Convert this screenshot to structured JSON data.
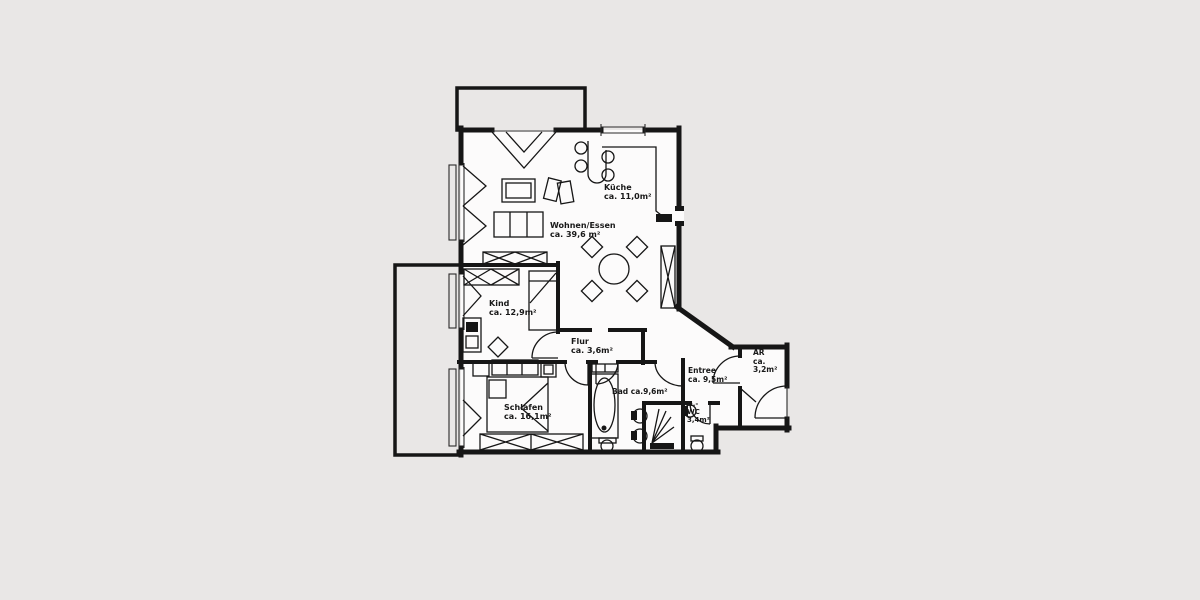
{
  "plan": {
    "type": "apartment-floorplan",
    "colors": {
      "background": "#e9e7e6",
      "paper": "#fcfbfb",
      "ink": "#161616"
    },
    "rooms": [
      {
        "id": "kueche",
        "lines": [
          "Küche",
          "ca. 11,0m²"
        ]
      },
      {
        "id": "wohnen",
        "lines": [
          "Wohnen/Essen",
          "ca. 39,6 m²"
        ]
      },
      {
        "id": "kind",
        "lines": [
          "Kind",
          "ca. 12,9m²"
        ]
      },
      {
        "id": "flur",
        "lines": [
          "Flur",
          "ca. 3,6m²"
        ]
      },
      {
        "id": "schlafen",
        "lines": [
          "Schlafen",
          "ca. 16,1m²"
        ]
      },
      {
        "id": "bad",
        "lines": [
          "Bad ca.9,6m²"
        ]
      },
      {
        "id": "entree",
        "lines": [
          "Entree",
          "ca. 9,5m²"
        ]
      },
      {
        "id": "ar",
        "lines": [
          "AR",
          "ca.",
          "3,2m²"
        ]
      },
      {
        "id": "g-wc",
        "lines": [
          "G.-",
          "WC",
          "3,4m²"
        ]
      }
    ]
  }
}
